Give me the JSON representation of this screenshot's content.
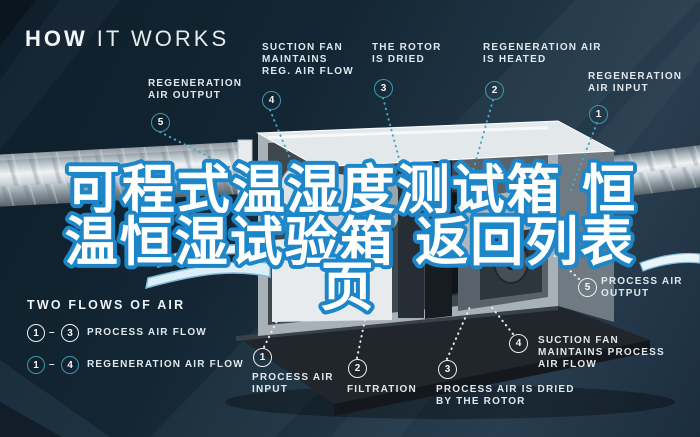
{
  "title": {
    "word_bold": "HOW",
    "word_light": "IT WORKS"
  },
  "overlay": {
    "line1": "可程式温湿度测试箱 恒",
    "line2": "温恒湿试验箱 返回列表",
    "line3": "页"
  },
  "top_labels": [
    {
      "num": "1",
      "line1": "REGENERATION",
      "line2": "AIR INPUT"
    },
    {
      "num": "2",
      "line1": "REGENERATION AIR",
      "line2": "IS HEATED"
    },
    {
      "num": "3",
      "line1": "THE ROTOR",
      "line2": "IS DRIED"
    },
    {
      "num": "4",
      "line1": "SUCTION FAN",
      "line2": "MAINTAINS",
      "line3": "REG. AIR FLOW"
    },
    {
      "num": "5",
      "line1": "REGENERATION",
      "line2": "AIR OUTPUT"
    }
  ],
  "bottom_labels": [
    {
      "num": "1",
      "line1": "PROCESS AIR",
      "line2": "INPUT"
    },
    {
      "num": "2",
      "line1": "FILTRATION"
    },
    {
      "num": "3",
      "line1": "PROCESS AIR IS DRIED",
      "line2": "BY THE ROTOR"
    },
    {
      "num": "4",
      "line1": "SUCTION FAN",
      "line2": "MAINTAINS PROCESS",
      "line3": "AIR FLOW"
    },
    {
      "num": "5",
      "line1": "PROCESS AIR",
      "line2": "OUTPUT"
    }
  ],
  "legend": {
    "heading": "TWO FLOWS OF AIR",
    "process": {
      "from": "1",
      "to": "3",
      "label": "PROCESS AIR FLOW"
    },
    "regeneration": {
      "from": "1",
      "to": "4",
      "label": "REGENERATION AIR FLOW"
    }
  },
  "colors": {
    "background_navy": "#15293a",
    "accent_teal": "#3f97ad",
    "label_white": "#dfe8ed",
    "overlay_fill": "#ffffff",
    "overlay_stroke": "#1c86c8",
    "duct_metal": "#cfd7dc",
    "machine_base": "#20262c"
  }
}
